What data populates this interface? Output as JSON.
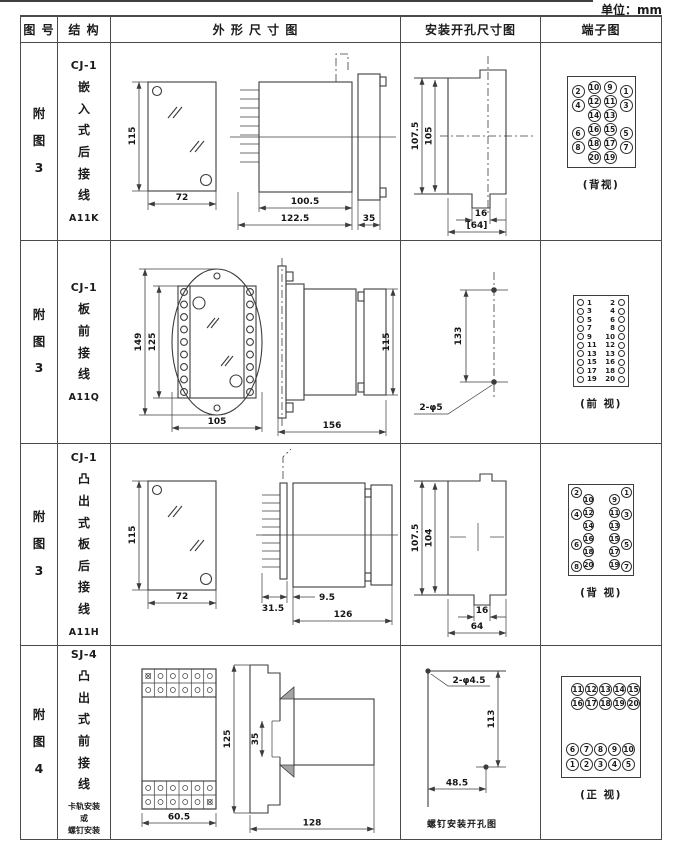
{
  "page": {
    "unit_label": "单位：mm"
  },
  "header": {
    "fig": "图 号",
    "structure": "结 构",
    "outline": "外 形 尺 寸 图",
    "mounting": "安装开孔尺寸图",
    "terminal": "端子图"
  },
  "rows": [
    {
      "fig": "附图3",
      "structure": {
        "model": "CJ-1",
        "desc": "嵌入式后接线",
        "code": "A11K"
      },
      "outline": {
        "h": "115",
        "w": "72",
        "d1": "100.5",
        "d2": "122.5",
        "d3": "35"
      },
      "mounting": {
        "v1": "107.5",
        "v2": "105",
        "n1": "16",
        "n2": "[64]"
      },
      "terminal": {
        "caption": "(背视)",
        "outer_left": [
          "2",
          "4",
          "6",
          "8"
        ],
        "inner_left": [
          "10",
          "12",
          "14",
          "16",
          "18",
          "20"
        ],
        "inner_right": [
          "9",
          "11",
          "13",
          "15",
          "17",
          "19"
        ],
        "outer_right": [
          "1",
          "3",
          "5",
          "7"
        ]
      }
    },
    {
      "fig": "附图3",
      "structure": {
        "model": "CJ-1",
        "desc": "板前接线",
        "code": "A11Q"
      },
      "outline": {
        "v1": "149",
        "v2": "125",
        "w": "105",
        "len": "156",
        "h": "115"
      },
      "mounting": {
        "dist": "133",
        "holes": "2-φ5"
      },
      "terminal": {
        "caption": "(前 视)",
        "left": [
          "1",
          "3",
          "5",
          "7",
          "9",
          "11",
          "13",
          "15",
          "17",
          "19"
        ],
        "right": [
          "2",
          "4",
          "6",
          "8",
          "10",
          "12",
          "13",
          "16",
          "18",
          "20"
        ]
      }
    },
    {
      "fig": "附图3",
      "structure": {
        "model": "CJ-1",
        "desc": "凸出式板后接线",
        "code": "A11H"
      },
      "outline": {
        "h": "115",
        "w": "72",
        "d1": "31.5",
        "d2": "9.5",
        "d3": "126"
      },
      "mounting": {
        "v1": "107.5",
        "v2": "104",
        "n1": "16",
        "n2": "64"
      },
      "terminal": {
        "caption": "(背 视)",
        "outer_left": [
          "2",
          "4",
          "6",
          "8"
        ],
        "inner_left": [
          "10",
          "12",
          "14",
          "16",
          "18",
          "20"
        ],
        "inner_right": [
          "9",
          "11",
          "13",
          "15",
          "17",
          "19"
        ],
        "outer_right": [
          "1",
          "3",
          "5",
          "7"
        ]
      }
    },
    {
      "fig": "附图4",
      "structure": {
        "model": "SJ-4",
        "desc": "凸出式前接线",
        "note": "卡轨安装\n或\n螺钉安装"
      },
      "outline": {
        "w": "60.5",
        "h": "125",
        "slot": "35",
        "len": "128"
      },
      "mounting": {
        "holes": "2-φ4.5",
        "v": "113",
        "w": "48.5",
        "caption": "螺钉安装开孔图"
      },
      "terminal": {
        "caption": "(正 视)",
        "row1": [
          "11",
          "12",
          "13",
          "14",
          "15"
        ],
        "row2": [
          "16",
          "17",
          "18",
          "19",
          "20"
        ],
        "row3": [
          "6",
          "7",
          "8",
          "9",
          "10"
        ],
        "row4": [
          "1",
          "2",
          "3",
          "4",
          "5"
        ]
      }
    }
  ]
}
